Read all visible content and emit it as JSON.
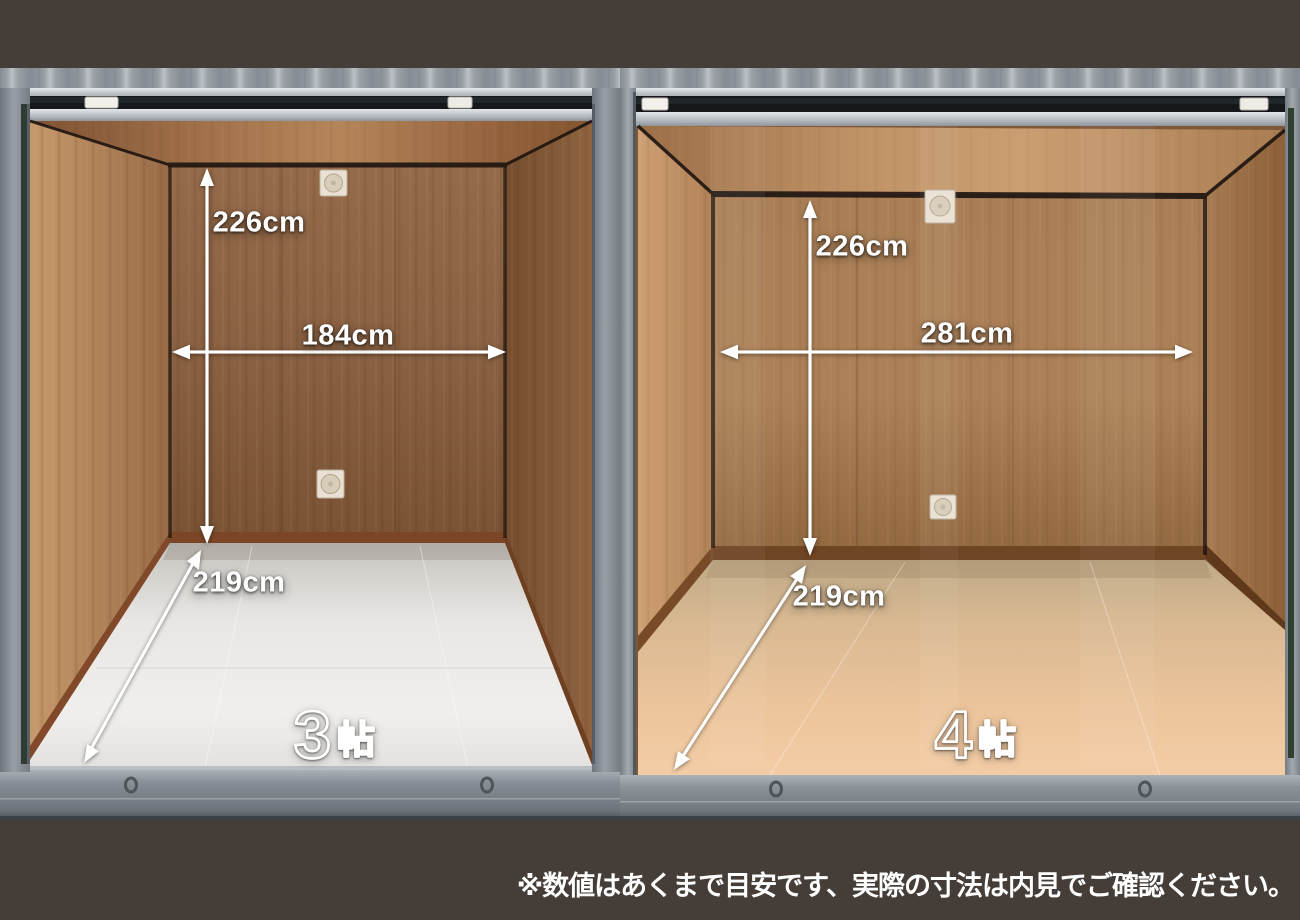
{
  "page": {
    "background_color": "#453d37",
    "frame_gray": "#828990",
    "arrow_color": "#ffffff"
  },
  "units": [
    {
      "name": "left-storage-unit",
      "size_number": "3",
      "size_suffix": "帖",
      "dimensions": {
        "height": "226cm",
        "width": "184cm",
        "depth": "219cm"
      },
      "wood_color": "#8a6142",
      "floor_color": "#e9e7e4"
    },
    {
      "name": "right-storage-unit",
      "size_number": "4",
      "size_suffix": "帖",
      "dimensions": {
        "height": "226cm",
        "width": "281cm",
        "depth": "219cm"
      },
      "wood_color": "#a87c54",
      "floor_color": "#e7bf97"
    }
  ],
  "footnote": "※数値はあくまで目安です、実際の寸法は内見でご確認ください。"
}
